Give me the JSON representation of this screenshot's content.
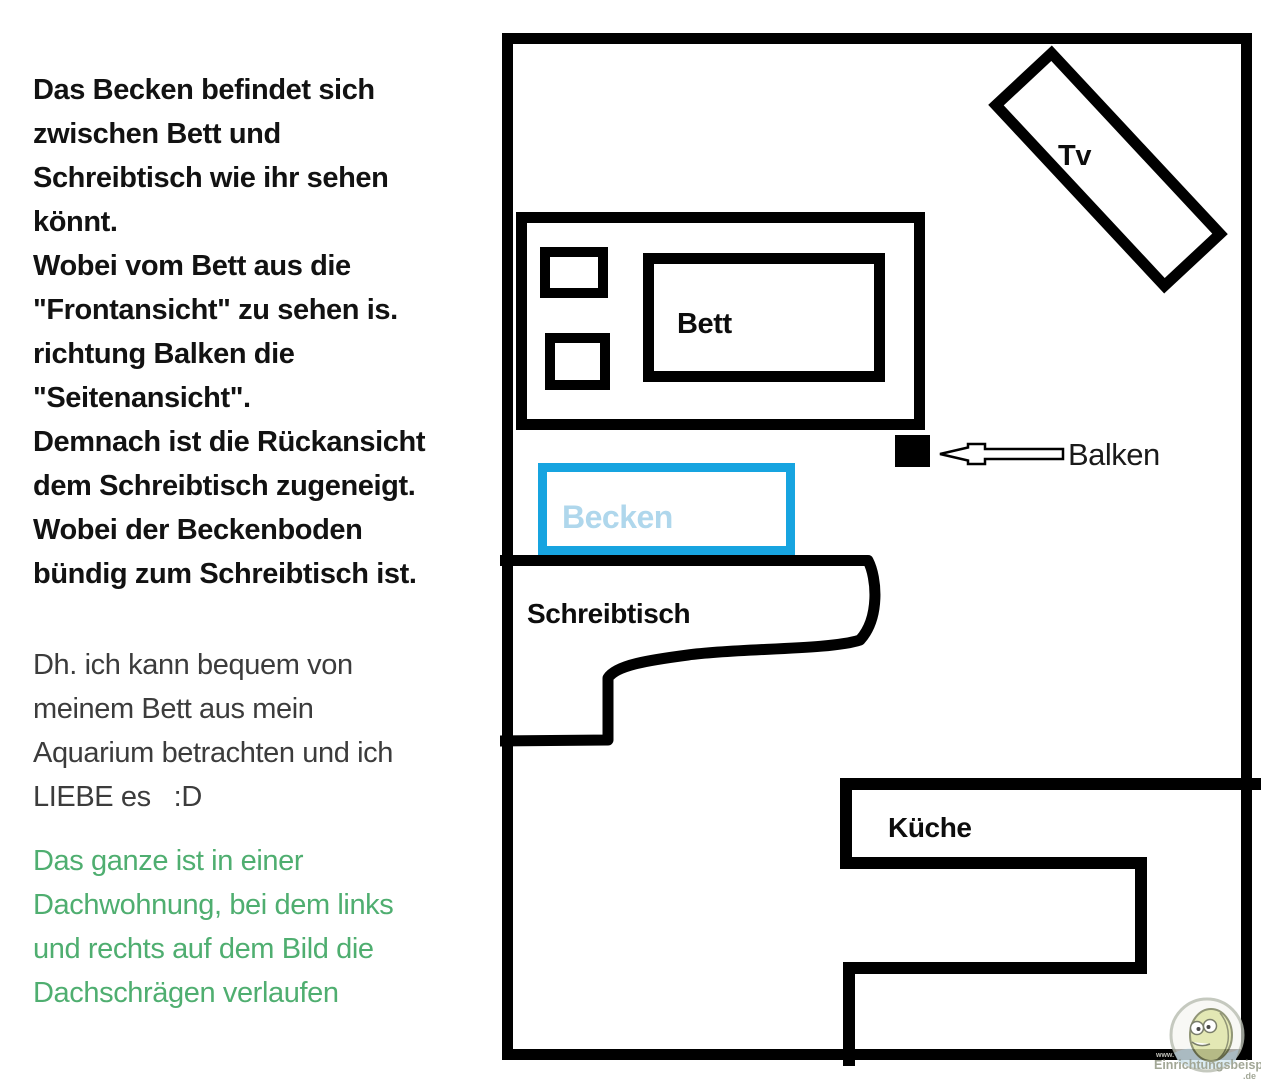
{
  "colors": {
    "background": "#ffffff",
    "line_black": "#000000",
    "text_bold_black": "#121212",
    "text_gray": "#3c3c3c",
    "text_green": "#4fae70",
    "becken_border": "#17a4e0",
    "becken_text": "#afd7ec"
  },
  "notes": {
    "paragraph_bold": "Das Becken befindet sich\nzwischen Bett und\nSchreibtisch wie ihr sehen\nkönnt.\nWobei vom Bett aus die\n\"Frontansicht\" zu sehen is.\nrichtung Balken die\n\"Seitenansicht\".\nDemnach ist die Rückansicht\ndem Schreibtisch zugeneigt.\nWobei der Beckenboden\nbündig zum Schreibtisch ist.",
    "paragraph_plain": "Dh. ich kann bequem von\nmeinem Bett aus mein\nAquarium betrachten und ich\nLIEBE es   :D",
    "paragraph_green": "Das ganze ist in einer\nDachwohnung, bei dem links\nund rechts auf dem Bild die\nDachschrägen verlaufen"
  },
  "floor_plan": {
    "labels": {
      "tv": "Tv",
      "bett": "Bett",
      "balken": "Balken",
      "becken": "Becken",
      "schreibtisch": "Schreibtisch",
      "kueche": "Küche"
    },
    "watermark": {
      "www": "www.",
      "site": "Einrichtungsbeispiele",
      "tld": ".de"
    }
  }
}
